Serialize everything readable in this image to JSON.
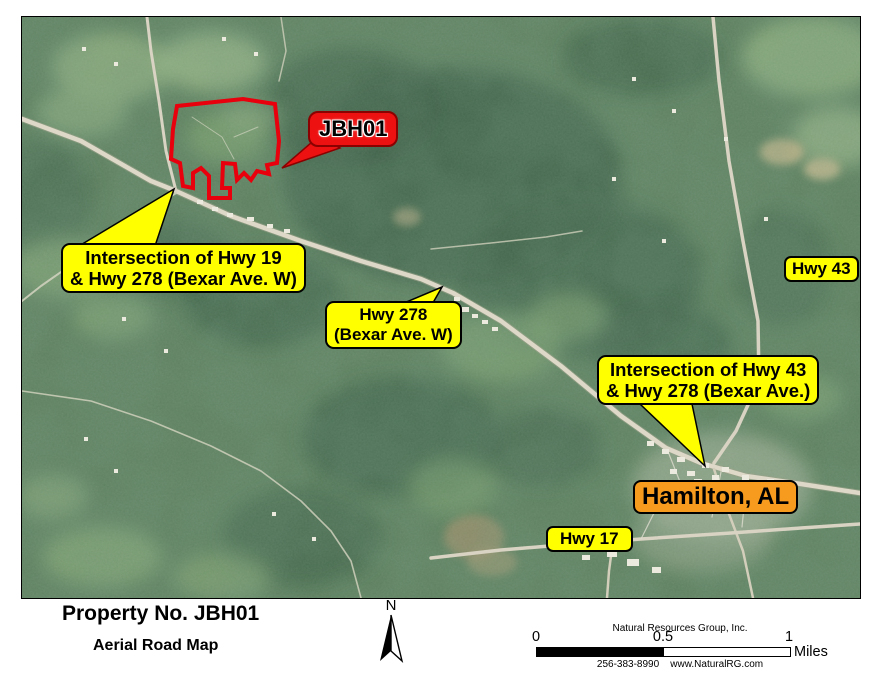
{
  "map": {
    "property_callout": {
      "label": "JBH01"
    },
    "callout_hwy19_278": {
      "line1": "Intersection of Hwy 19",
      "line2": "& Hwy 278 (Bexar Ave. W)"
    },
    "callout_hwy278": {
      "line1": "Hwy 278",
      "line2": "(Bexar Ave. W)"
    },
    "label_hwy43": "Hwy 43",
    "callout_hwy43_278": {
      "line1": "Intersection of Hwy 43",
      "line2": "& Hwy 278 (Bexar Ave.)"
    },
    "label_hamilton": "Hamilton, AL",
    "label_hwy17": "Hwy 17"
  },
  "footer": {
    "title": "Property No. JBH01",
    "subtitle": "Aerial Road Map",
    "north_arrow_label": "N",
    "company_line1": "Natural Resources Group, Inc.",
    "company_line2": "256-383-8990    www.NaturalRG.com",
    "scale_bar": {
      "tick_0": "0",
      "tick_mid": "0.5",
      "tick_1": "1",
      "units": "Miles"
    }
  },
  "colors": {
    "callout_yellow": "#FFFF00",
    "property_outline_red": "#E8000D",
    "jbh01_box_red": "#EE1111",
    "hamilton_orange": "#F79B1E"
  }
}
